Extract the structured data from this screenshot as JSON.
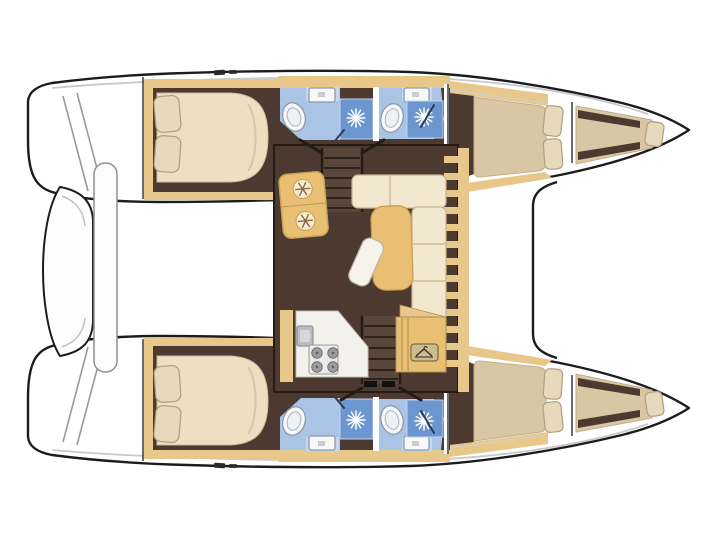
{
  "scene": {
    "kind": "catamaran-yacht-floorplan-top-view",
    "orientation": "bow-right",
    "hulls": 2,
    "double_cabins": 4,
    "bathrooms": 4,
    "bow_berths": 2
  },
  "colors": {
    "background": "#ffffff",
    "outline": "#1c1c1c",
    "deck_white": "#ffffff",
    "deck_shadow": "#c9c9c9",
    "wood": "#e8c88a",
    "wood_dark": "#c49e55",
    "floor_brown": "#4c3a30",
    "stair_brown": "#59463a",
    "tread_line": "#2e231c",
    "bed_cream": "#ecdfc2",
    "bed_beige": "#d9c6a4",
    "pillow": "#e6d9bc",
    "pillow_edge": "#b3a383",
    "bath_blue": "#aac4e6",
    "bath_blue_light": "#c6d8f0",
    "shower_blue": "#6c96cf",
    "fixture_white": "#f8f8f6",
    "fixture_edge": "#8a9ab0",
    "table_tan": "#e9bf74",
    "sofa_cream": "#f2e8d0",
    "sofa_edge": "#c6b48e",
    "counter_white": "#f3f1ec",
    "burner_gray": "#9c9c9c",
    "metal_gray": "#b9bdc1",
    "icon_brown": "#8a6a45",
    "snow_circle": "#f6ead0"
  },
  "icons": {
    "shower_spray_icon": "starburst",
    "snowflake_icon": "snowflake",
    "hanger_icon": "clothes-hanger",
    "stove_icon": "four-burner-hob"
  }
}
